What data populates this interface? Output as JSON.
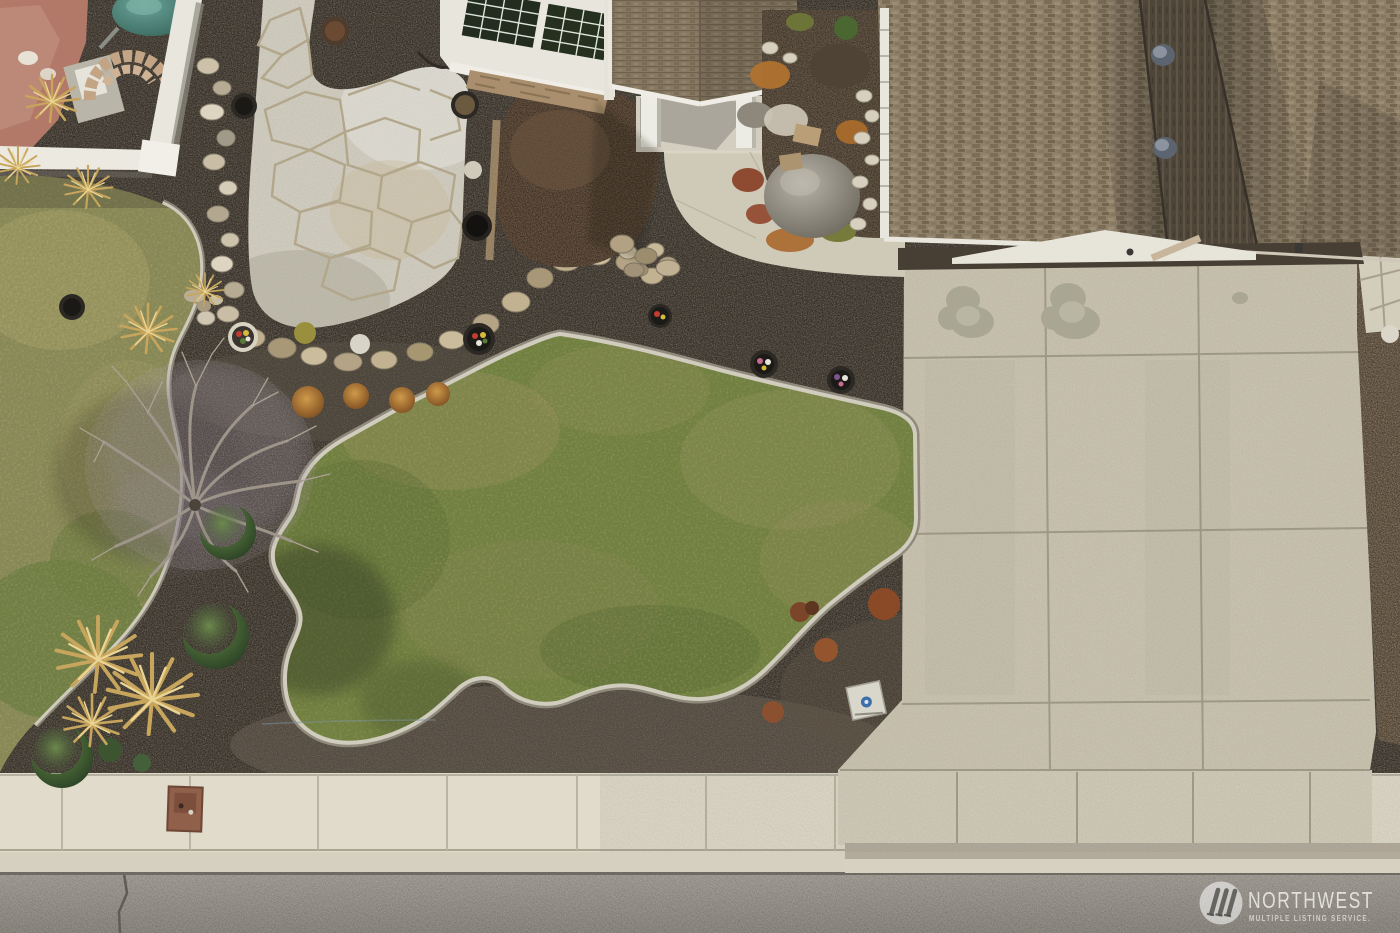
{
  "watermark": {
    "brand": "NORTHWEST",
    "tagline": "MULTIPLE LISTING SERVICE.",
    "logo": "nwmls-triple-slash-icon"
  },
  "scene": {
    "type": "aerial-drone-photo",
    "subject": "top-down view of front-yard landscaping of a single-family home",
    "elements": [
      "brown shingled hip roof with two vents",
      "gabled entry roof with white posts",
      "angled bay windows with white siding",
      "flagstone patio",
      "kidney-shaped lawn with concrete curbing",
      "dry left lawn",
      "dark gravel xeriscape beds",
      "bare deciduous tree",
      "golden ornamental grasses",
      "evergreen shrubs",
      "orange barberry shrubs",
      "flower pots and planters",
      "rock garden with boulder and sedum",
      "curved concrete walkway",
      "large concrete driveway with stains",
      "concrete sidewalk with utility box",
      "asphalt street with crack",
      "neighbor fence, teal tank and block ring"
    ],
    "palette": {
      "gravel_dark": "#4a4238",
      "gravel_light": "#6a5a46",
      "lawn_green": "#71803f",
      "lawn_dry": "#8b8a58",
      "concrete_light": "#dcd7c6",
      "concrete_drive": "#cdc6b2",
      "curb": "#d0ccbe",
      "flagstone": "#d6d2c5",
      "flagstone_joint": "#b2a68b",
      "roof_brown": "#8e8069",
      "roof_shadow": "#4e4639",
      "street_gray": "#938f87",
      "mulch_brown": "#5e4a38",
      "sedum_orange": "#b0722f",
      "teal_tank": "#47857a",
      "fence_white": "#ece9e0",
      "utility_box_brown": "#91604b",
      "watermark_white": "#f4f2ec"
    }
  }
}
